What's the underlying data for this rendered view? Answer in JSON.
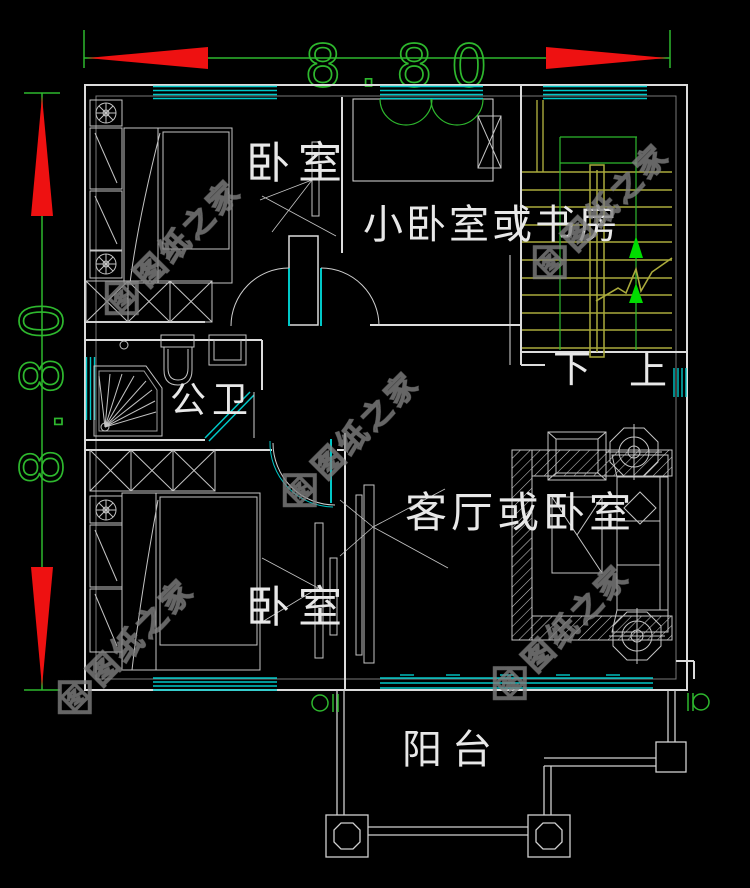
{
  "colors": {
    "background": "#000000",
    "wall": "#dcdcdc",
    "window_cyan": "#00c8c8",
    "dimension_green": "#2eb82e",
    "arrow_red": "#ee1111",
    "stair_yellow": "#aaaa3c",
    "stair_arrow_green": "#00dd00",
    "label_white": "#e8e8e8",
    "watermark_gray": "#808080"
  },
  "dimensions": {
    "top": {
      "value": "8.80"
    },
    "left": {
      "value": "8.80"
    }
  },
  "rooms": {
    "bedroom_top": {
      "label": "卧室"
    },
    "study": {
      "label": "小卧室或书房"
    },
    "bathroom": {
      "label": "公卫"
    },
    "bedroom_bottom": {
      "label": "卧室"
    },
    "living": {
      "label": "客厅或卧室"
    },
    "balcony": {
      "label": "阳台"
    }
  },
  "stairs": {
    "down": "下",
    "up": "上"
  },
  "watermark": {
    "text": "图纸之家",
    "logo_char": "图"
  }
}
